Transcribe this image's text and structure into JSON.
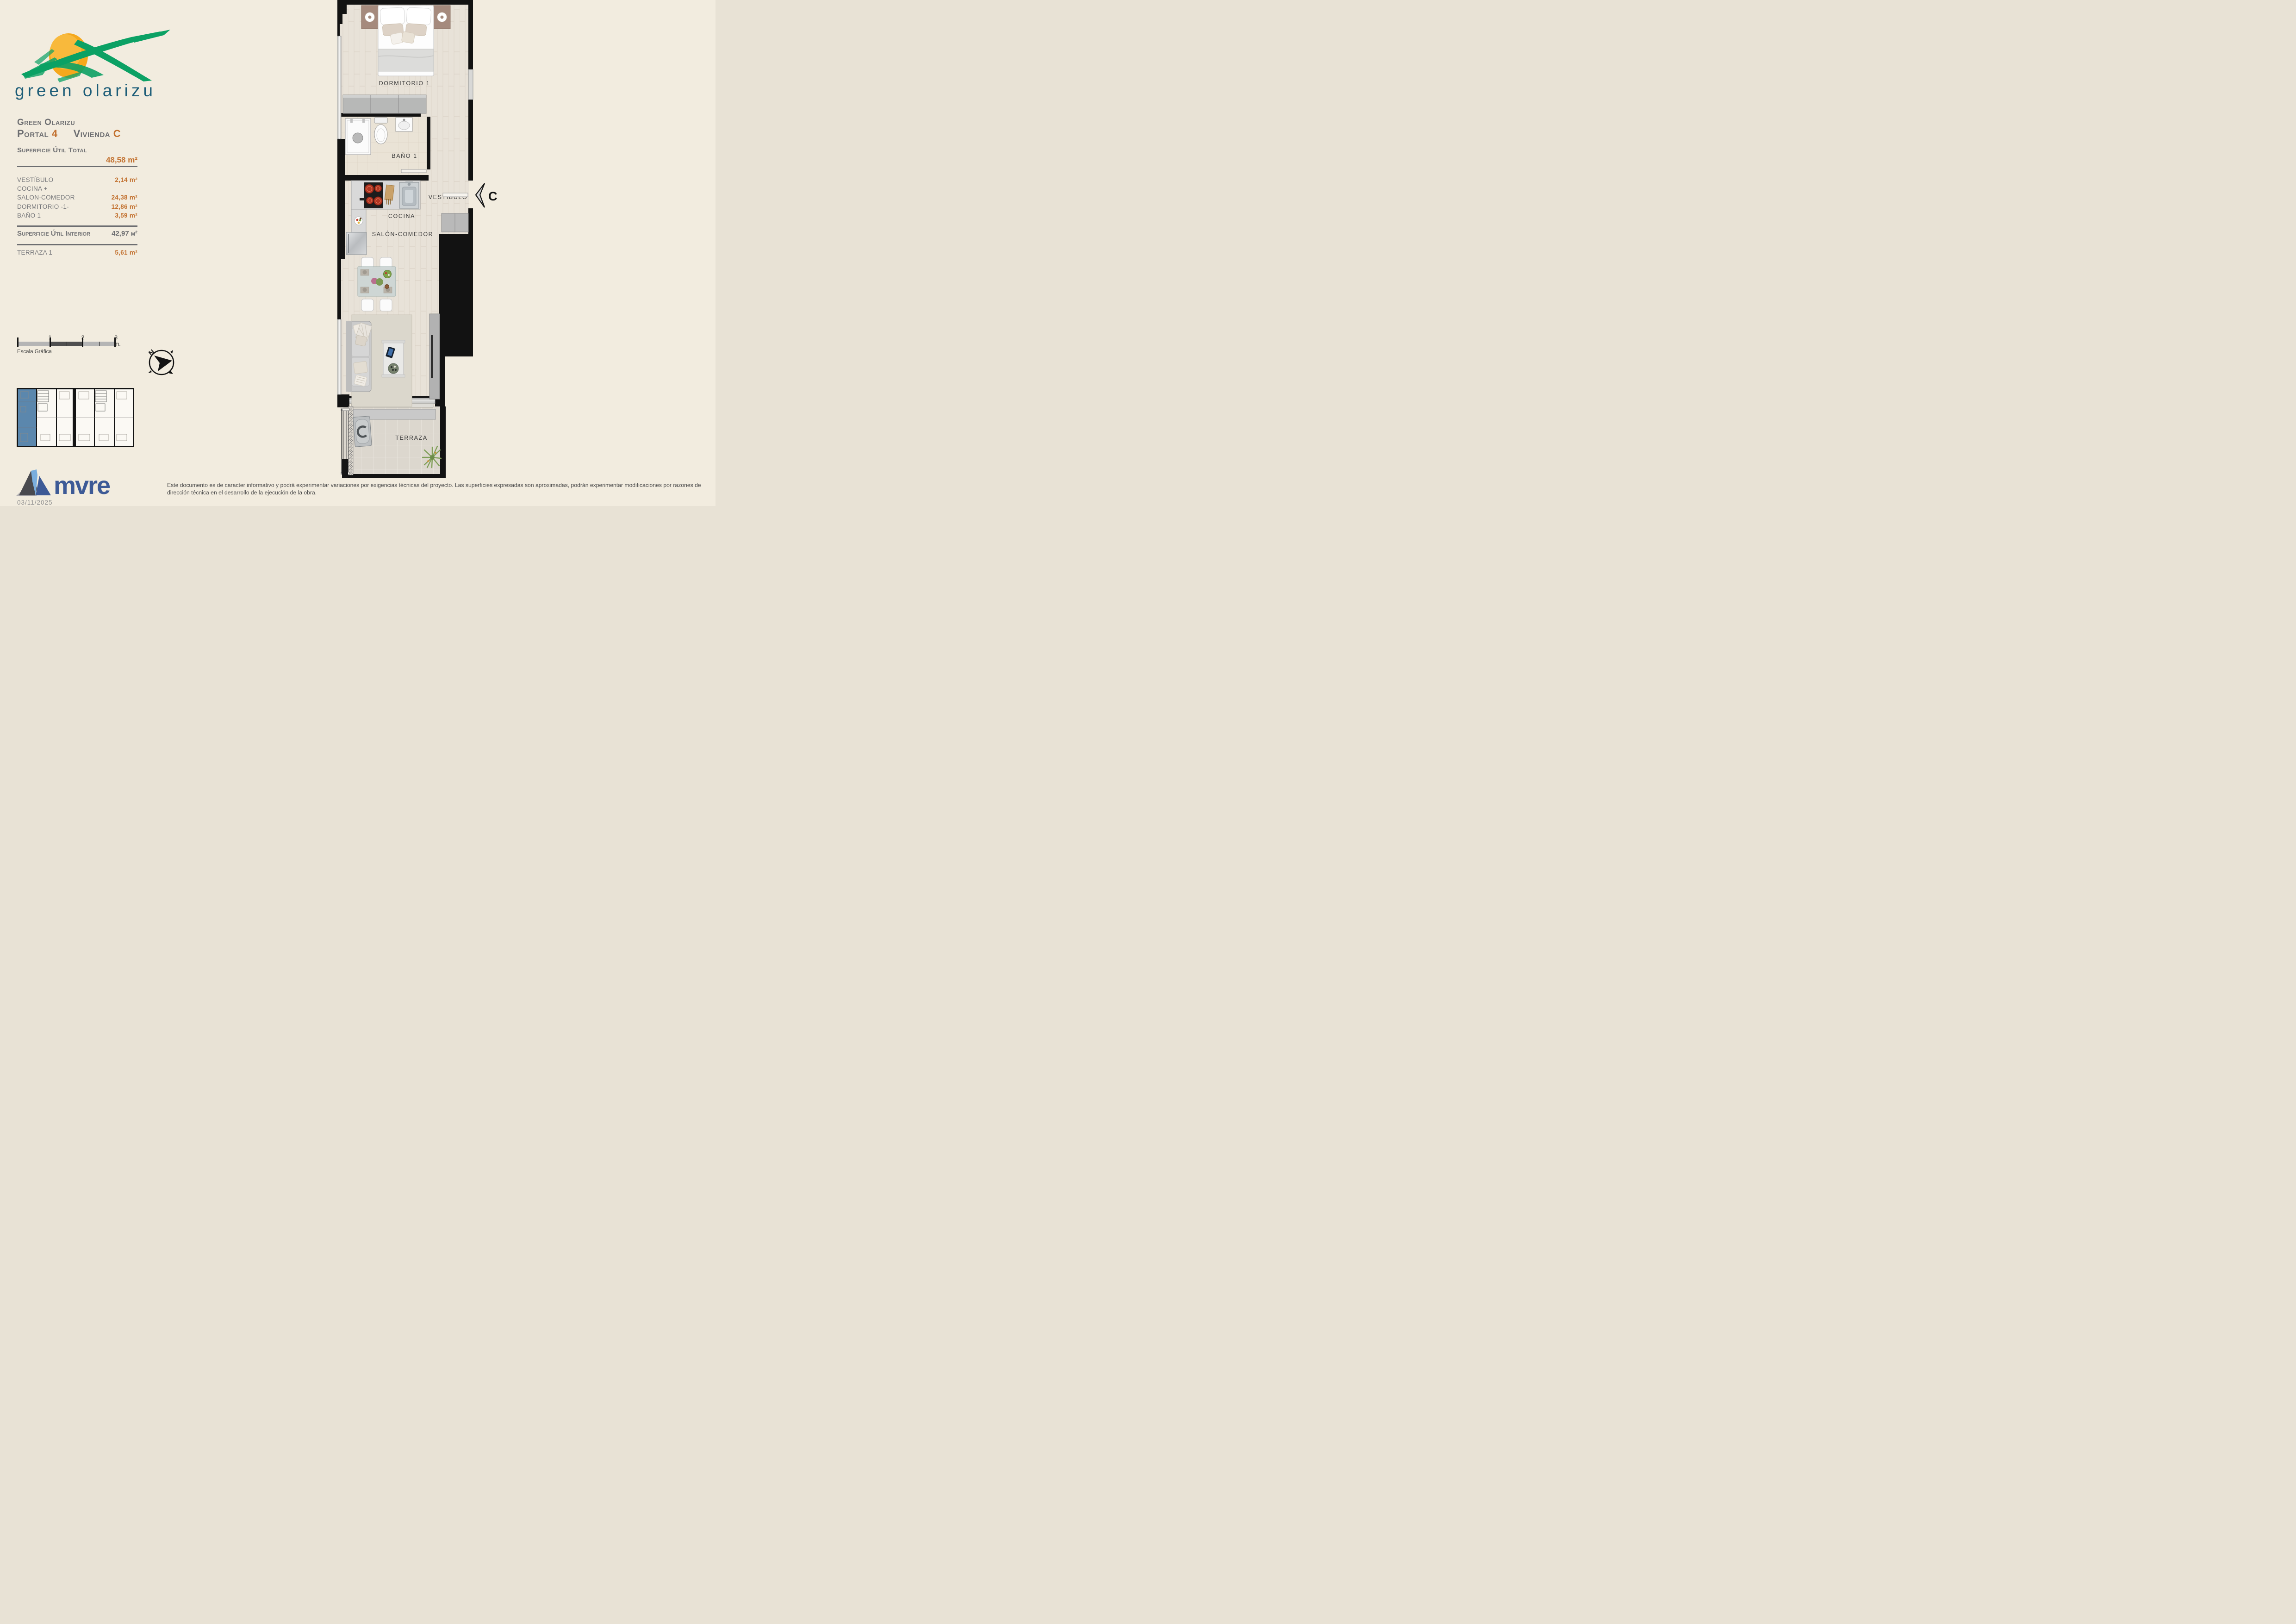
{
  "logo": {
    "text": "green olarizu"
  },
  "header": {
    "project": "Green Olarizu",
    "portal_label": "Portal",
    "portal_value": "4",
    "vivienda_label": "Vivienda",
    "vivienda_value": "C"
  },
  "surface_table": {
    "total_label": "Superficie Útil Total",
    "total_value": "48,58 m²",
    "rows": [
      {
        "label": "VESTÍBULO",
        "value": "2,14 m²"
      },
      {
        "label": "COCINA +",
        "value": ""
      },
      {
        "label": "SALON-COMEDOR",
        "value": "24,38 m²"
      },
      {
        "label": "DORMITORIO -1-",
        "value": "12,86 m²"
      },
      {
        "label": "BAÑO 1",
        "value": "3,59 m²"
      }
    ],
    "interior_label": "Superficie Útil Interior",
    "interior_value": "42,97 m²",
    "terraza_label": "TERRAZA 1",
    "terraza_value": "5,61 m²"
  },
  "scale_bar": {
    "tick_1": "1",
    "tick_2": "2",
    "tick_3": "3 m.",
    "caption": "Escala Gráfica"
  },
  "compass": {
    "north": "N"
  },
  "floor_plan": {
    "labels": {
      "dormitorio": "DORMITORIO 1",
      "bano": "BAÑO 1",
      "vestibulo": "VESTÍBULO",
      "cocina": "COCINA",
      "salon": "SALÓN-COMEDOR",
      "terraza": "TERRAZA"
    },
    "entry_marker": "C"
  },
  "footer": {
    "developer_logo_text": "mvre",
    "date": "03/11/2025",
    "disclaimer": "Este documento es de caracter informativo y podrá experimentar variaciones por exigencias técnicas del proyecto. Las superficies expresadas son aproximadas, podrán experimentar modificaciones por razones de dirección técnica en el desarrollo de la ejecución de la obra."
  },
  "colors": {
    "accent_orange": "#c2702e",
    "text_gray": "#6d6e71",
    "logo_green": "#0ba164",
    "logo_teal": "#1d5d78",
    "mvre_blue": "#3d5a96",
    "keyplan_highlight": "#5b87ad",
    "wall_black": "#121212",
    "background_cream": "#f2ecdf"
  }
}
